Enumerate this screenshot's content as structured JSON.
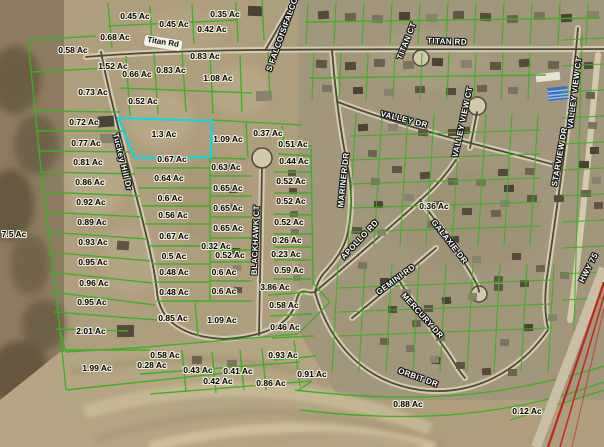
{
  "map": {
    "type": "gis-parcel-aerial-map",
    "colors": {
      "parcel_line": "#3cb022",
      "highlight": "#00dde6",
      "highway": "#c0261c",
      "acre_text": "#000000",
      "street_text": "#ffffff"
    },
    "highlighted_parcel": {
      "label": "1.3 Ac",
      "color": "#00dde6"
    },
    "parcel_labels": [
      {
        "text": "0.45 Ac",
        "x": 135,
        "y": 16
      },
      {
        "text": "0.45 Ac",
        "x": 174,
        "y": 24
      },
      {
        "text": "0.35 Ac",
        "x": 225,
        "y": 14
      },
      {
        "text": "0.42 Ac",
        "x": 212,
        "y": 29
      },
      {
        "text": "0.68 Ac",
        "x": 115,
        "y": 37
      },
      {
        "text": "0.58 Ac",
        "x": 73,
        "y": 50
      },
      {
        "text": "0.83 Ac",
        "x": 205,
        "y": 56
      },
      {
        "text": "1.52 Ac",
        "x": 113,
        "y": 66
      },
      {
        "text": "0.83 Ac",
        "x": 171,
        "y": 70
      },
      {
        "text": "0.66 Ac",
        "x": 137,
        "y": 74
      },
      {
        "text": "1.08 Ac",
        "x": 218,
        "y": 78
      },
      {
        "text": "0.73 Ac",
        "x": 93,
        "y": 92
      },
      {
        "text": "0.52 Ac",
        "x": 143,
        "y": 101
      },
      {
        "text": "0.72 Ac",
        "x": 84,
        "y": 122
      },
      {
        "text": "1.3 Ac",
        "x": 164,
        "y": 134,
        "highlight": true
      },
      {
        "text": "1.09 Ac",
        "x": 228,
        "y": 139
      },
      {
        "text": "0.37 Ac",
        "x": 268,
        "y": 133
      },
      {
        "text": "0.77 Ac",
        "x": 86,
        "y": 143
      },
      {
        "text": "0.51 Ac",
        "x": 293,
        "y": 144
      },
      {
        "text": "0.44 Ac",
        "x": 294,
        "y": 161
      },
      {
        "text": "0.81 Ac",
        "x": 88,
        "y": 162
      },
      {
        "text": "0.67 Ac",
        "x": 172,
        "y": 159
      },
      {
        "text": "0.63 Ac",
        "x": 226,
        "y": 167
      },
      {
        "text": "0.64 Ac",
        "x": 169,
        "y": 178
      },
      {
        "text": "0.52 Ac",
        "x": 291,
        "y": 181
      },
      {
        "text": "0.86 Ac",
        "x": 90,
        "y": 182
      },
      {
        "text": "0.65 Ac",
        "x": 228,
        "y": 188
      },
      {
        "text": "0.6 Ac",
        "x": 170,
        "y": 198
      },
      {
        "text": "0.52 Ac",
        "x": 291,
        "y": 201
      },
      {
        "text": "0.92 Ac",
        "x": 91,
        "y": 202
      },
      {
        "text": "0.65 Ac",
        "x": 228,
        "y": 208
      },
      {
        "text": "0.56 Ac",
        "x": 173,
        "y": 215
      },
      {
        "text": "0.52 Ac",
        "x": 289,
        "y": 222
      },
      {
        "text": "0.89 Ac",
        "x": 92,
        "y": 222
      },
      {
        "text": "0.65 Ac",
        "x": 228,
        "y": 228
      },
      {
        "text": "0.67 Ac",
        "x": 174,
        "y": 236
      },
      {
        "text": "0.32 Ac",
        "x": 216,
        "y": 246
      },
      {
        "text": "0.26 Ac",
        "x": 287,
        "y": 240
      },
      {
        "text": "0.93 Ac",
        "x": 93,
        "y": 242
      },
      {
        "text": "0.23 Ac",
        "x": 286,
        "y": 254
      },
      {
        "text": "0.52 Ac",
        "x": 230,
        "y": 255
      },
      {
        "text": "0.5 Ac",
        "x": 174,
        "y": 256
      },
      {
        "text": "0.95 Ac",
        "x": 93,
        "y": 262
      },
      {
        "text": "0.48 Ac",
        "x": 174,
        "y": 272
      },
      {
        "text": "0.6 Ac",
        "x": 224,
        "y": 272
      },
      {
        "text": "0.59 Ac",
        "x": 289,
        "y": 270
      },
      {
        "text": "0.96 Ac",
        "x": 94,
        "y": 283
      },
      {
        "text": "0.48 Ac",
        "x": 174,
        "y": 292
      },
      {
        "text": "0.6 Ac",
        "x": 224,
        "y": 291
      },
      {
        "text": "3.86 Ac",
        "x": 275,
        "y": 287
      },
      {
        "text": "0.95 Ac",
        "x": 92,
        "y": 302
      },
      {
        "text": "0.58 Ac",
        "x": 284,
        "y": 305
      },
      {
        "text": "0.85 Ac",
        "x": 173,
        "y": 318
      },
      {
        "text": "1.09 Ac",
        "x": 222,
        "y": 320
      },
      {
        "text": "0.46 Ac",
        "x": 285,
        "y": 327
      },
      {
        "text": "2.01 Ac",
        "x": 91,
        "y": 331
      },
      {
        "text": "0.58 Ac",
        "x": 165,
        "y": 355
      },
      {
        "text": "0.93 Ac",
        "x": 283,
        "y": 355
      },
      {
        "text": "0.28 Ac",
        "x": 152,
        "y": 365
      },
      {
        "text": "0.43 Ac",
        "x": 198,
        "y": 370
      },
      {
        "text": "0.41 Ac",
        "x": 238,
        "y": 371
      },
      {
        "text": "1.99 Ac",
        "x": 97,
        "y": 368
      },
      {
        "text": "0.42 Ac",
        "x": 218,
        "y": 381
      },
      {
        "text": "0.86 Ac",
        "x": 271,
        "y": 383
      },
      {
        "text": "0.91 Ac",
        "x": 312,
        "y": 374
      },
      {
        "text": "0.36 Ac",
        "x": 434,
        "y": 206
      },
      {
        "text": "0.88 Ac",
        "x": 408,
        "y": 404
      },
      {
        "text": "0.12 Ac",
        "x": 527,
        "y": 411
      },
      {
        "text": "7.5 Ac",
        "x": 14,
        "y": 234
      }
    ],
    "street_labels": [
      {
        "text": "Titan Rd",
        "x": 163,
        "y": 43,
        "rot": 9,
        "style": "pill"
      },
      {
        "text": "TITAN RD",
        "x": 447,
        "y": 42,
        "rot": 2,
        "style": "halo"
      },
      {
        "text": "TITAN CT",
        "x": 407,
        "y": 41,
        "rot": -68,
        "style": "halo"
      },
      {
        "text": "S FALCON CT",
        "x": 279,
        "y": 44,
        "rot": -70,
        "style": "halo"
      },
      {
        "text": "S FALCON CT",
        "x": 293,
        "y": 6,
        "rot": -70,
        "style": "halo"
      },
      {
        "text": "VALLEY DR",
        "x": 404,
        "y": 120,
        "rot": 14,
        "style": "halo"
      },
      {
        "text": "VALLEY VIEW CT",
        "x": 463,
        "y": 122,
        "rot": -78,
        "style": "halo"
      },
      {
        "text": "VALLEY VIEW CT",
        "x": 575,
        "y": 93,
        "rot": -83,
        "style": "halo"
      },
      {
        "text": "STARVIEW DR",
        "x": 560,
        "y": 157,
        "rot": -80,
        "style": "halo"
      },
      {
        "text": "MARINER DR",
        "x": 344,
        "y": 180,
        "rot": -84,
        "style": "halo"
      },
      {
        "text": "APOLLO RD",
        "x": 360,
        "y": 240,
        "rot": -47,
        "style": "halo"
      },
      {
        "text": "GALAXIE DR",
        "x": 449,
        "y": 242,
        "rot": 52,
        "style": "halo"
      },
      {
        "text": "GEMINI RD",
        "x": 396,
        "y": 280,
        "rot": -36,
        "style": "halo"
      },
      {
        "text": "MERCURY DR",
        "x": 422,
        "y": 316,
        "rot": 48,
        "style": "halo"
      },
      {
        "text": "ORBIT DR",
        "x": 418,
        "y": 378,
        "rot": 20,
        "style": "halo"
      },
      {
        "text": "BLACKHAWK CT",
        "x": 256,
        "y": 240,
        "rot": -88,
        "style": "halo"
      },
      {
        "text": "Tuckey Hill Dr",
        "x": 122,
        "y": 162,
        "rot": 76,
        "style": "halo"
      },
      {
        "text": "HWY 75",
        "x": 589,
        "y": 268,
        "rot": -63,
        "style": "halo"
      }
    ]
  }
}
